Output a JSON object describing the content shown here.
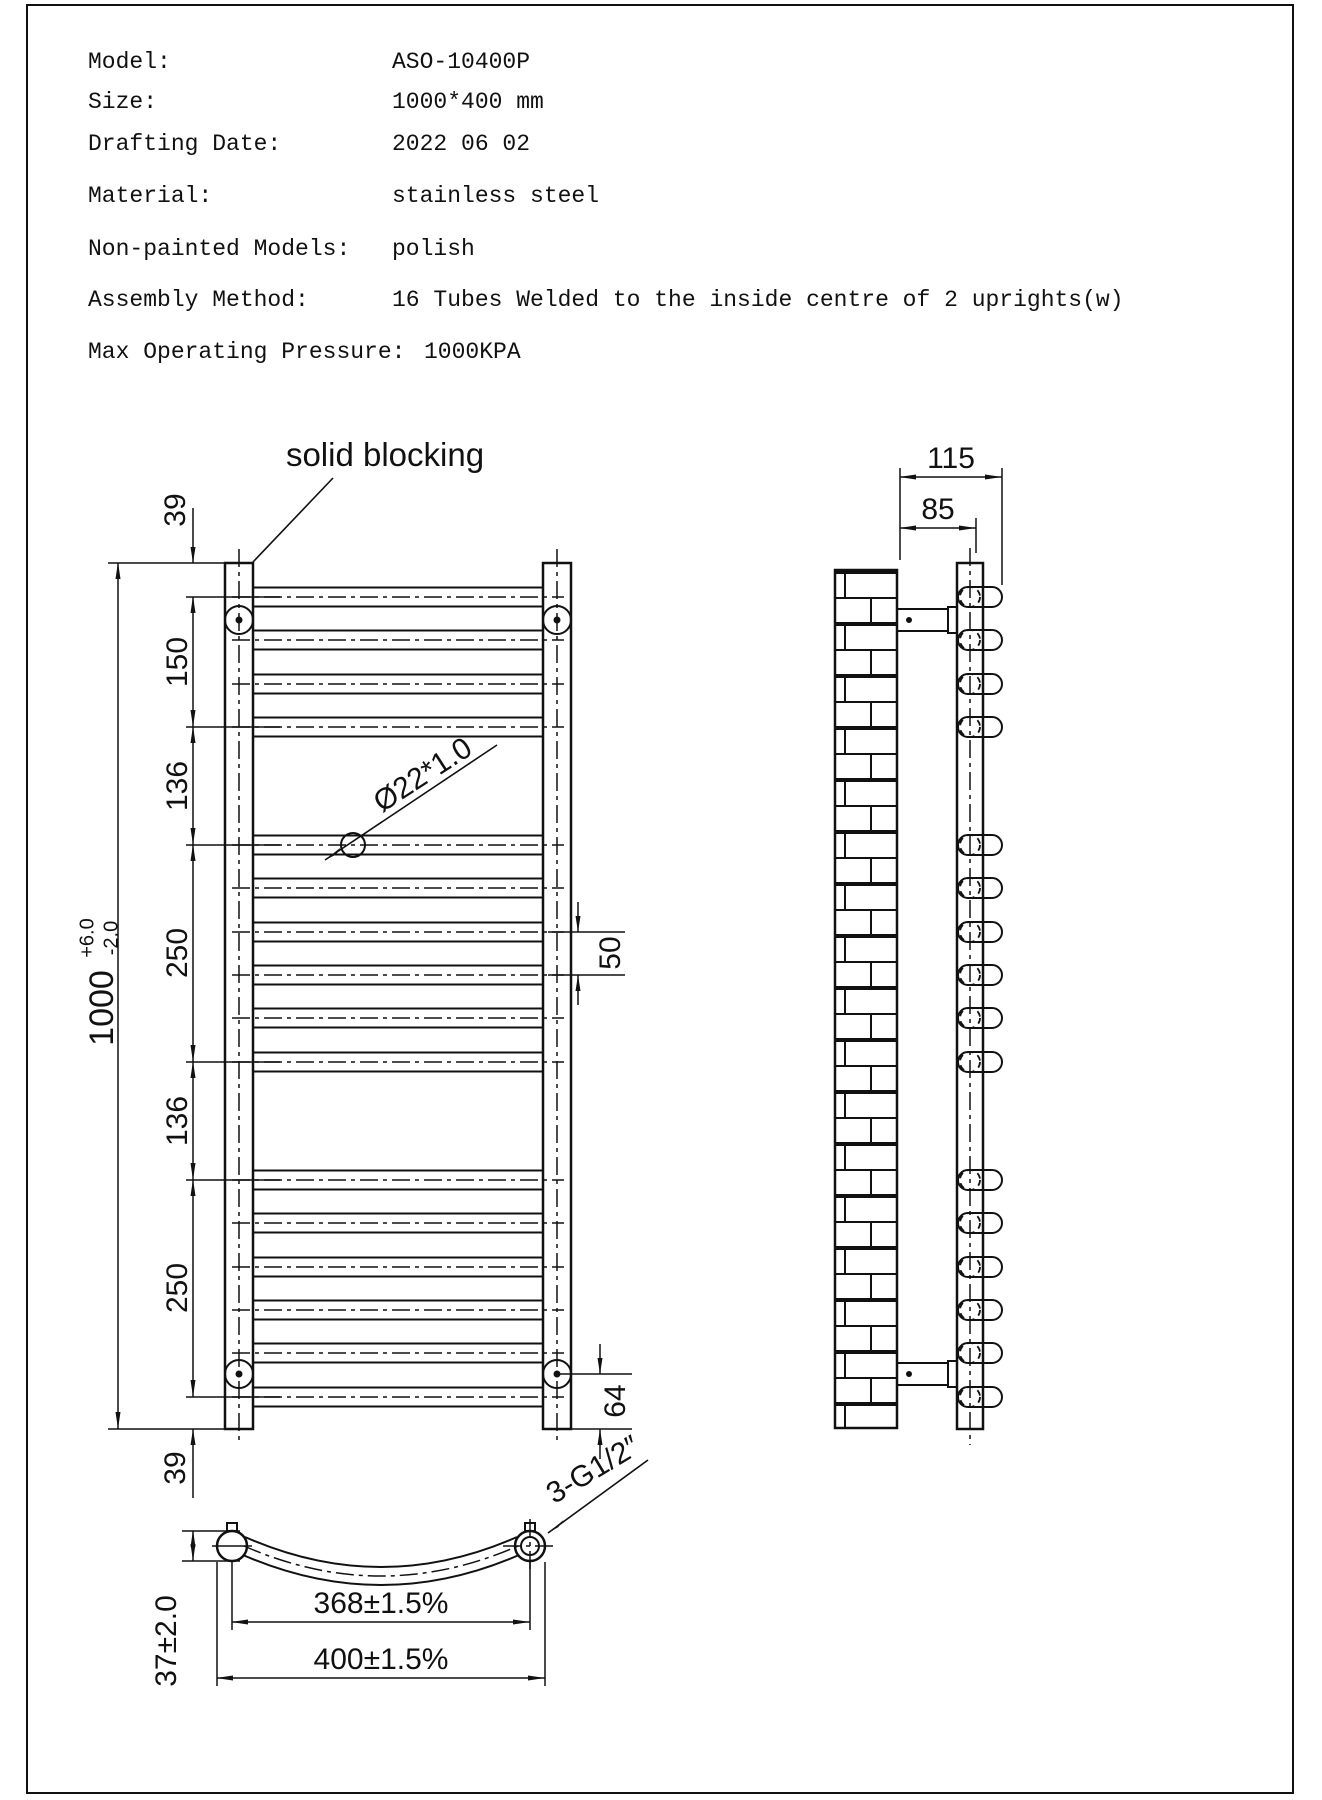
{
  "specs": {
    "rows": [
      {
        "label": "Model:",
        "value": "ASO-10400P"
      },
      {
        "label": "Size:",
        "value": "1000*400 mm"
      },
      {
        "label": "Drafting Date:",
        "value": "2022 06 02"
      },
      {
        "label": "Material:",
        "value": "stainless steel"
      },
      {
        "label": "Non-painted Models:",
        "value": "polish"
      },
      {
        "label": "Assembly Method:",
        "value": "16 Tubes Welded to the inside centre of 2 uprights(w)"
      }
    ],
    "pressure": {
      "label": "Max Operating Pressure:",
      "value": "1000KPA"
    }
  },
  "front_view": {
    "annotation": "solid blocking",
    "dims": {
      "top_offset": "39",
      "seg_150": "150",
      "seg_136_upper": "136",
      "seg_250_upper": "250",
      "seg_136_lower": "136",
      "seg_250_lower": "250",
      "bottom_offset": "39",
      "overall": "1000",
      "tol_plus": "+6.0",
      "tol_minus": "-2.0",
      "tube_spec": "Ø22*1.0",
      "tube_pitch": "50",
      "bracket_to_end": "64"
    }
  },
  "side_view": {
    "dims": {
      "total_depth": "115",
      "wall_to_rail": "85"
    }
  },
  "plan_view": {
    "dims": {
      "tube_centres": "368±1.5%",
      "overall_width": "400±1.5%",
      "bow_depth": "37±2.0",
      "connections": "3-G1/2″"
    }
  },
  "line_color": "#111111"
}
